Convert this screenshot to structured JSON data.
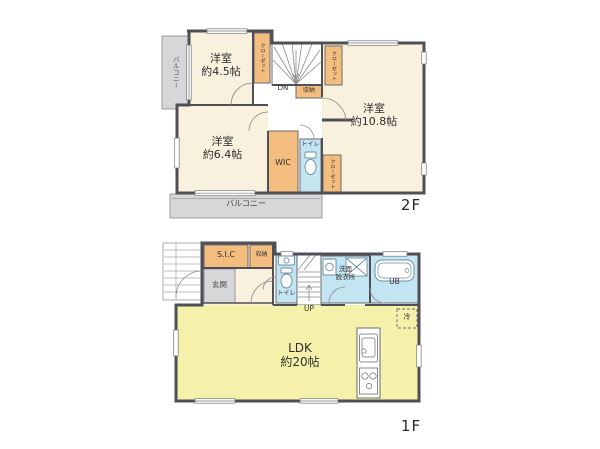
{
  "floor2": {
    "floor_label": "2F",
    "rooms": {
      "room_4_5": {
        "name": "洋室",
        "size": "約4.5帖"
      },
      "room_6_4": {
        "name": "洋室",
        "size": "約6.4帖"
      },
      "room_10_8": {
        "name": "洋室",
        "size": "約10.8帖"
      }
    },
    "wic_label": "WIC",
    "toilet_label": "トイレ",
    "closet_label": "クローゼット",
    "storage_label": "収納",
    "stairs_label": "DN",
    "balcony_side_label": "バルコニー",
    "balcony_bottom_label": "バルコニー"
  },
  "floor1": {
    "floor_label": "1F",
    "ldk": {
      "name": "LDK",
      "size": "約20帖"
    },
    "entrance_label": "玄関",
    "sic_label": "S.I.C",
    "storage_label": "収納",
    "toilet_label": "トイレ",
    "washroom_label_line1": "洗面",
    "washroom_label_line2": "脱衣所",
    "bath_label": "UB",
    "stairs_label": "UP",
    "fridge_label": "冷"
  },
  "colors": {
    "room_fill": "#f8f1de",
    "closet_fill": "#f4bd80",
    "wet_area_fill": "#c3e4f1",
    "ldk_fill": "#f5f1ab",
    "balcony_fill": "#d7d7da",
    "entrance_fill": "#d7d7da",
    "wall": "#4f4f55"
  }
}
